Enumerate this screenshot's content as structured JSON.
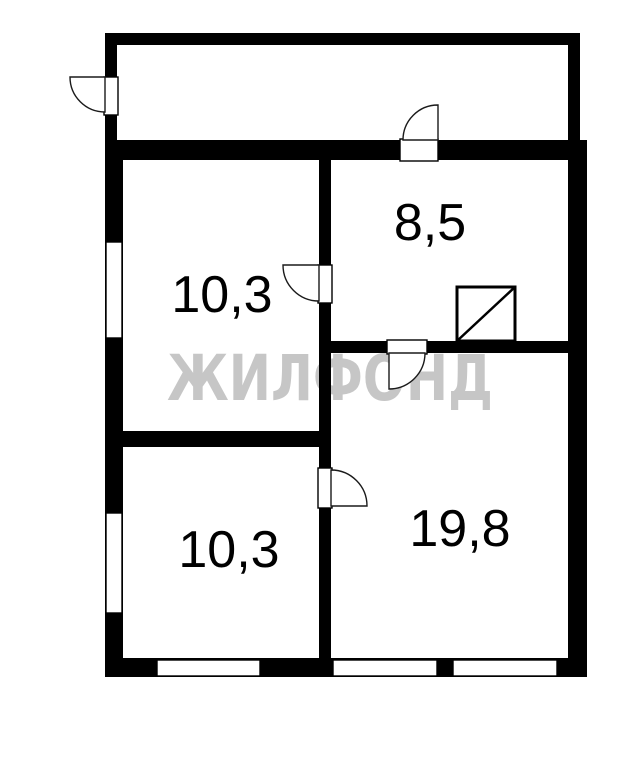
{
  "watermark": {
    "text": "ЖИЛФОНД",
    "color": "#c6c6c6"
  },
  "rooms": [
    {
      "id": "upper-left",
      "area_label": "10,3"
    },
    {
      "id": "upper-right",
      "area_label": "8,5"
    },
    {
      "id": "lower-left",
      "area_label": "10,3"
    },
    {
      "id": "lower-right",
      "area_label": "19,8"
    }
  ],
  "colors": {
    "wall": "#000000",
    "background": "#ffffff",
    "room_label": "#000000"
  }
}
